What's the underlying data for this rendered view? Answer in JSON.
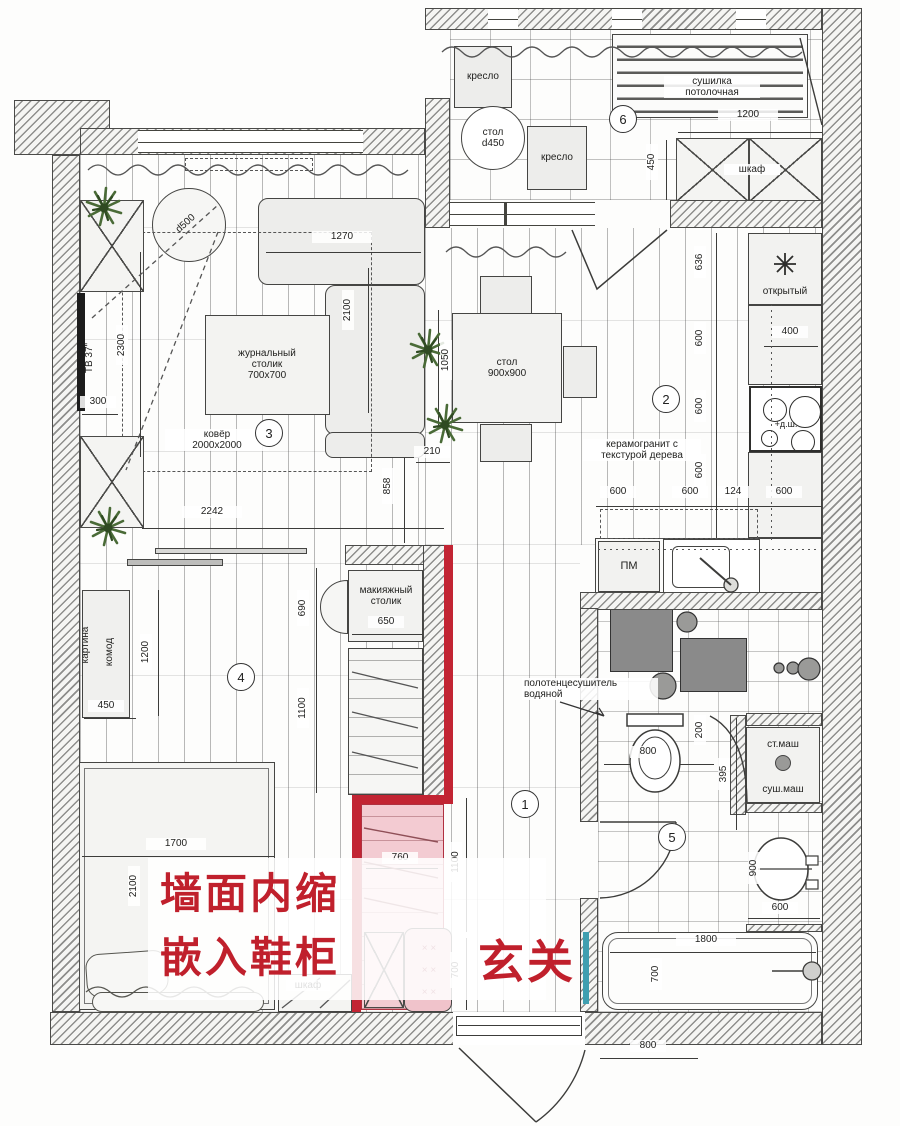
{
  "zones": {
    "hall": "1",
    "kitchen": "2",
    "living": "3",
    "bedroom": "4",
    "bath": "5",
    "balcony": "6"
  },
  "balcony": {
    "armchair1": "кресло",
    "table": "стол\nd450",
    "armchair2": "кресло",
    "dryer": "сушилка\nпотолочная",
    "wardrobe": "шкаф",
    "dim_width": "1200",
    "dim_depth": "450"
  },
  "living": {
    "sofa_width": "1270",
    "sofa_length": "2100",
    "coffee_table": "журнальный\nстолик\n700х700",
    "rug": "ковёр\n2000х2000",
    "round_table": "d500",
    "tv": "ТВ 37\"",
    "dim_2300": "2300",
    "dim_300": "300",
    "dim_2242": "2242",
    "dim_858": "858",
    "dim_210": "210"
  },
  "kitchen": {
    "table": "стол\n900х900",
    "dim_1050": "1050",
    "floor_note": "керамогранит с\nтекстурой дерева",
    "open_shelf": "открытый",
    "dim_400": "400",
    "oven": "+д.ш.",
    "dishwasher": "ПМ",
    "dim_636": "636",
    "dim_600v1": "600",
    "dim_600v2": "600",
    "dim_600v3": "600",
    "dims_bottom": [
      "600",
      "600",
      "124",
      "600"
    ]
  },
  "bedroom": {
    "picture": "картина",
    "dresser": "комод",
    "dim_450": "450",
    "dim_1200": "1200",
    "dim_690": "690",
    "dim_1100": "1100",
    "bed_width": "1700",
    "bed_length": "2100",
    "closet": "шкаф",
    "makeup_table": "макияжный\nстолик",
    "dim_650": "650"
  },
  "shoe": {
    "dim_760": "760",
    "dim_1100": "1100",
    "dim_700": "700",
    "ottoman_marks": "×   ×\n×   ×\n×   ×"
  },
  "hall": {
    "entry_label": "玄关",
    "note_line1": "墙面内缩",
    "note_line2": "嵌入鞋柜",
    "dim_800": "800"
  },
  "bath": {
    "towel_dryer": "полотенцесушитель\nводяной",
    "dim_200": "200",
    "dim_395": "395",
    "dim_800": "800",
    "washer": "ст.маш",
    "dryer": "суш.маш",
    "dim_900": "900",
    "dim_600": "600",
    "tub_length": "1800",
    "tub_width": "700"
  }
}
